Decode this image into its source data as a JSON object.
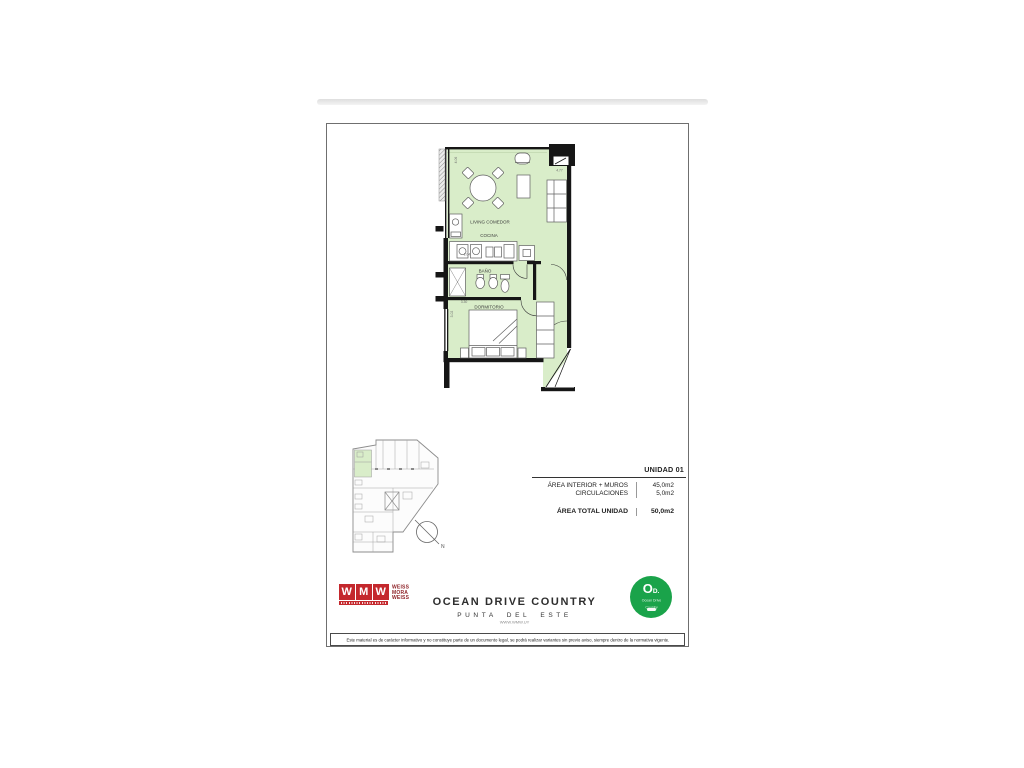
{
  "floor_plan": {
    "room_labels": {
      "living": "LIVING COMEDOR",
      "kitchen": "COCINA",
      "bath": "BAÑO",
      "bedroom": "DORMITORIO"
    },
    "dim_labels": {
      "top_left": "4.06",
      "top_right": "4.77",
      "kitchen": "2.04",
      "bath": "3.30",
      "bedroom": "3.02"
    }
  },
  "site_plan": {
    "north": "N"
  },
  "unit_info": {
    "title": "UNIDAD 01",
    "rows": [
      {
        "label": "ÁREA INTERIOR + MUROS",
        "value": "45,0m2"
      },
      {
        "label": "CIRCULACIONES",
        "value": "5,0m2"
      }
    ],
    "total_label": "ÁREA TOTAL UNIDAD",
    "total_value": "50,0m2"
  },
  "footer": {
    "logo_letters": [
      "W",
      "M",
      "W"
    ],
    "logo_name": "WEISS MORA WEISS",
    "logo_name_lines": {
      "l1": "WEISS",
      "l2": "MORA",
      "l3": "WEISS"
    },
    "project": "OCEAN DRIVE COUNTRY",
    "location": "PUNTA DEL ESTE",
    "website": "WWW.WMW.UY",
    "badge": {
      "big": "O",
      "small": "D.",
      "line1": "Ocean Drive",
      "line2": "Country"
    },
    "disclaimer": "Este material es de carácter informativo y no constituye parte de un documento legal, se podrá realizar variantes sin previo aviso, siempre dentro de la normativa vigente."
  },
  "colors": {
    "room_green": "#d9edc9",
    "wall_black": "#161616",
    "brand_red": "#c4282d",
    "badge_green": "#1aa34a"
  }
}
